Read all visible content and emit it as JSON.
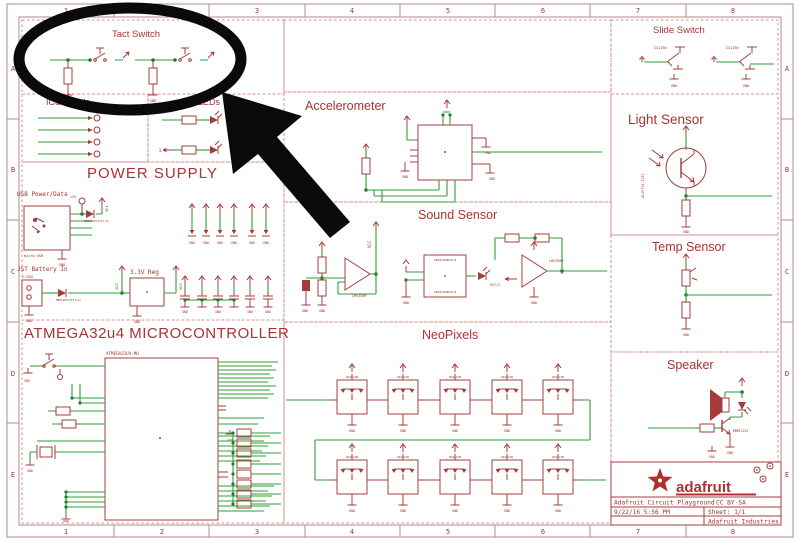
{
  "page_title": "Adafruit Circuit Playground Schematic",
  "grid": {
    "columns": [
      "1",
      "2",
      "3",
      "4",
      "5",
      "6",
      "7",
      "8"
    ],
    "rows": [
      "A",
      "B",
      "C",
      "D",
      "E"
    ]
  },
  "sections": {
    "tact_switch": "Tact Switch",
    "icsp_pads": "ICSP Pads",
    "leds": "LEDs",
    "power_supply": "POWER SUPPLY",
    "microcontroller": "ATMEGA32u4 MICROCONTROLLER",
    "accelerometer": "Accelerometer",
    "sound_sensor": "Sound Sensor",
    "neopixels": "NeoPixels",
    "slide_switch": "Slide Switch",
    "light_sensor": "Light Sensor",
    "temp_sensor": "Temp Sensor",
    "speaker": "Speaker"
  },
  "labels": {
    "gnd": "GND",
    "vcc": "VCC",
    "plus5v": "+5V",
    "usb_power": "USB Power/Data",
    "micro_usb": "micro USB",
    "jst": "JST Battery In",
    "jst_voltage": "2-5VDC",
    "diode_part": "MBR120VLSFT1(A)",
    "reg": "3.3V Reg",
    "mcu_part": "ATMEGA32U4-MU",
    "slide_part": "SG1290",
    "light_part": "ALSPT19-315C",
    "opamp_part": "LMV358M",
    "mic_part": "SPW2430HR5H-B",
    "vcc_half": "VCC/2",
    "transistor_part": "MMBT2222",
    "neopixel_part": "WS2812B",
    "one": "1"
  },
  "title_block": {
    "brand": "adafruit",
    "product": "Adafruit Circuit Playground",
    "license": "CC BY-SA",
    "date": "9/22/16 5:56 PM",
    "sheet": "Sheet: 1/1",
    "company": "Adafruit Industries"
  },
  "annotation": {
    "highlight_target": "Tact Switch"
  },
  "colors": {
    "schematic_red": "#A43C3C",
    "wire_green": "#2F9E3A",
    "divider_pink": "#D49090",
    "annotation_black": "#0A0A0A"
  }
}
